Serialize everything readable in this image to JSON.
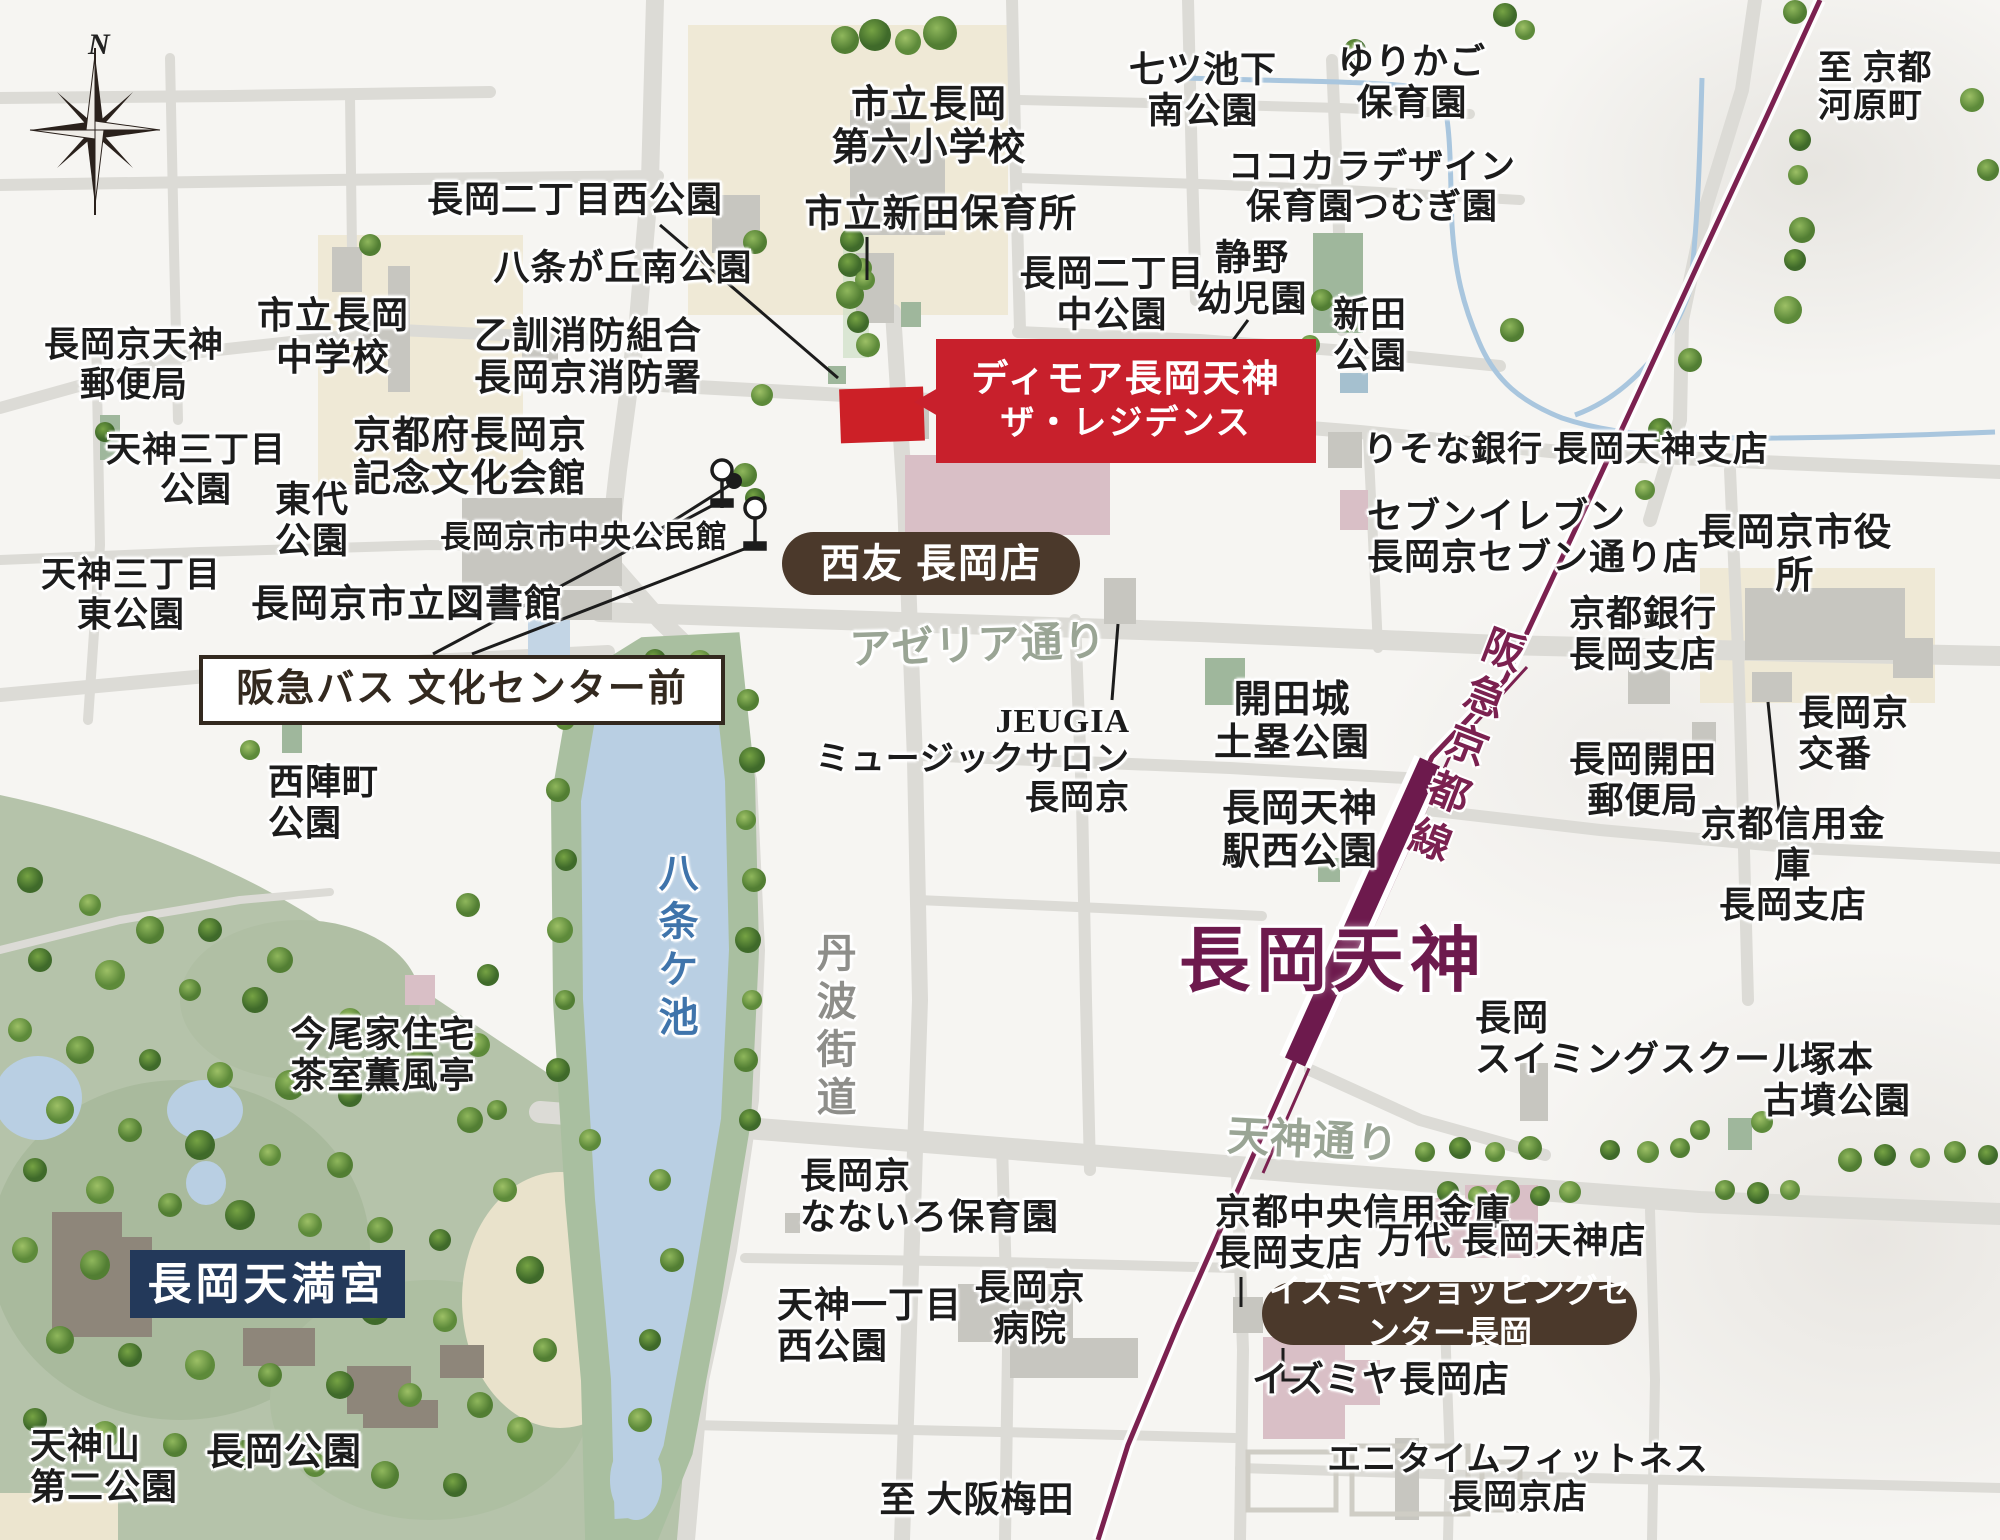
{
  "title": "長岡天神エリア 周辺案内図",
  "colors": {
    "railway_purple": "#7b2150",
    "station_text_purple": "#6d1a4d",
    "property_red": "#c8202c",
    "brand_brown": "#4b392b",
    "tenmangu_navy": "#23395a",
    "pond_blue": "#b9cfe3",
    "water_text_blue": "#3f74ab",
    "street_green": "#9aa595",
    "park_sage": "#b5c3aa"
  },
  "callouts": {
    "property": {
      "line1": "ディモア長岡天神",
      "line2": "ザ・レジデンス"
    },
    "seiyu": "西友 長岡店",
    "izumiya_sc": "イズミヤショッピングセンター長岡",
    "bus_stop": "阪急バス 文化センター前",
    "tenmangu": "長岡天満宮",
    "station": "長岡天神",
    "railway": "阪急京都線"
  },
  "compass": {
    "north": "N"
  },
  "map_labels": [
    {
      "name": "label-post-office-tenjin",
      "text": "長岡京天神\n郵便局",
      "x": 134,
      "y": 365,
      "fs": 35
    },
    {
      "name": "label-tenjin3-park",
      "text": "天神三丁目\n公園",
      "x": 196,
      "y": 470,
      "fs": 35
    },
    {
      "name": "label-tenjin3-east-park",
      "text": "天神三丁目\n東公園",
      "x": 131,
      "y": 595,
      "fs": 35
    },
    {
      "name": "label-municipal-jhs",
      "text": "市立長岡\n中学校",
      "x": 333,
      "y": 338,
      "fs": 37
    },
    {
      "name": "label-nagaoka2-west-park",
      "text": "長岡二丁目西公園",
      "x": 575,
      "y": 200,
      "fs": 36
    },
    {
      "name": "label-hachijo-south-park",
      "text": "八条が丘南公園",
      "x": 623,
      "y": 268,
      "fs": 36
    },
    {
      "name": "label-otokuni-fire-station",
      "text": "乙訓消防組合\n長岡京消防署",
      "x": 588,
      "y": 358,
      "fs": 37
    },
    {
      "name": "label-elementary-school",
      "text": "市立長岡\n第六小学校",
      "x": 929,
      "y": 127,
      "fs": 38
    },
    {
      "name": "label-shinden-nursery",
      "text": "市立新田保育所",
      "x": 941,
      "y": 215,
      "fs": 38
    },
    {
      "name": "label-nanatsuike-park",
      "text": "七ツ池下\n南公園",
      "x": 1203,
      "y": 90,
      "fs": 36
    },
    {
      "name": "label-yurikago-nursery",
      "text": "ゆりかご\n保育園",
      "x": 1412,
      "y": 82,
      "fs": 36
    },
    {
      "name": "label-kokokara-nursery",
      "text": "ココカラデザイン\n保育園つむぎ園",
      "x": 1372,
      "y": 187,
      "fs": 35
    },
    {
      "name": "label-to-kyoto-kawaramachi",
      "text": "至 京都\n河原町",
      "x": 1874,
      "y": 84,
      "fs": 34,
      "align": "left",
      "ax": 1818,
      "ay": 50
    },
    {
      "name": "label-nagaoka2-naka-park",
      "text": "長岡二丁目\n中公園",
      "x": 1112,
      "y": 294,
      "fs": 36
    },
    {
      "name": "label-shizuno-kindergarten",
      "text": "静野\n幼児園",
      "x": 1252,
      "y": 278,
      "fs": 36
    },
    {
      "name": "label-shinden-park",
      "text": "新田\n公園",
      "x": 1370,
      "y": 335,
      "fs": 36
    },
    {
      "name": "label-bunka-kaikan",
      "text": "京都府長岡京\n記念文化会館",
      "x": 470,
      "y": 458,
      "fs": 38
    },
    {
      "name": "label-todai-park",
      "text": "東代\n公園",
      "x": 312,
      "y": 520,
      "fs": 36
    },
    {
      "name": "label-chuo-kominkan",
      "text": "長岡京市中央公民館",
      "x": 584,
      "y": 537,
      "fs": 31
    },
    {
      "name": "label-city-library",
      "text": "長岡京市立図書館",
      "x": 407,
      "y": 605,
      "fs": 38
    },
    {
      "name": "label-risona-bank",
      "text": "りそな銀行 長岡天神支店",
      "x": 1566,
      "y": 450,
      "fs": 35
    },
    {
      "name": "label-seven-eleven",
      "text": "セブンイレブン\n長岡京セブン通り店",
      "x": 1530,
      "y": 538,
      "fs": 36,
      "align": "left",
      "ax": 1367,
      "ay": 496
    },
    {
      "name": "label-city-hall",
      "text": "長岡京市役所",
      "x": 1795,
      "y": 555,
      "fs": 38
    },
    {
      "name": "label-kyoto-bank",
      "text": "京都銀行\n長岡支店",
      "x": 1643,
      "y": 634,
      "fs": 36
    },
    {
      "name": "label-koban",
      "text": "長岡京\n交番",
      "x": 1845,
      "y": 733,
      "fs": 36,
      "align": "left",
      "ax": 1798,
      "ay": 693
    },
    {
      "name": "label-kaiden-post",
      "text": "長岡開田\n郵便局",
      "x": 1643,
      "y": 780,
      "fs": 36
    },
    {
      "name": "label-kyoto-shinyo",
      "text": "京都信用金庫\n長岡支店",
      "x": 1793,
      "y": 865,
      "fs": 36
    },
    {
      "name": "label-kaidenjo-park",
      "text": "開田城\n土塁公園",
      "x": 1292,
      "y": 722,
      "fs": 38
    },
    {
      "name": "label-jeugia",
      "text": "JEUGIA\nミュージックサロン\n長岡京",
      "x": 1014,
      "y": 760,
      "fs": 34,
      "align": "right",
      "ax": 1130,
      "ay": 703
    },
    {
      "name": "label-ekinishi-park",
      "text": "長岡天神\n駅西公園",
      "x": 1300,
      "y": 831,
      "fs": 38
    },
    {
      "name": "label-nishijin-park",
      "text": "西陣町\n公園",
      "x": 316,
      "y": 800,
      "fs": 36,
      "align": "left",
      "ax": 268,
      "ay": 762
    },
    {
      "name": "label-imao-house",
      "text": "今尾家住宅\n茶室薫風亭",
      "x": 383,
      "y": 1055,
      "fs": 36
    },
    {
      "name": "label-hachijogaike",
      "text": "八条ケ池",
      "x": 675,
      "y": 948,
      "fs": 40,
      "color": "#3f74ab",
      "vert": true
    },
    {
      "name": "label-tanba-kaido",
      "text": "丹波街道",
      "x": 833,
      "y": 1028,
      "fs": 40,
      "color": "#8e8e8a",
      "vert": true
    },
    {
      "name": "label-azeria-dori",
      "text": "アゼリア通り",
      "x": 978,
      "y": 647,
      "fs": 42,
      "color": "#9aa595",
      "rot": -2
    },
    {
      "name": "label-tenjin-dori",
      "text": "天神通り",
      "x": 1313,
      "y": 1142,
      "fs": 42,
      "color": "#9aa595",
      "rot": 3
    },
    {
      "name": "label-swimming-school",
      "text": "長岡\nスイミングスクール",
      "x": 1600,
      "y": 1036,
      "fs": 36,
      "align": "left",
      "ax": 1475,
      "ay": 998
    },
    {
      "name": "label-tsukamoto-kofun",
      "text": "塚本\n古墳公園",
      "x": 1837,
      "y": 1080,
      "fs": 36
    },
    {
      "name": "label-chuo-shinkin",
      "text": "京都中央信用金庫\n長岡支店",
      "x": 1306,
      "y": 1232,
      "fs": 36,
      "align": "left",
      "ax": 1215,
      "ay": 1192
    },
    {
      "name": "label-mandai",
      "text": "万代 長岡天神店",
      "x": 1512,
      "y": 1241,
      "fs": 36
    },
    {
      "name": "label-izumiya-store",
      "text": "イズミヤ長岡店",
      "x": 1381,
      "y": 1380,
      "fs": 36
    },
    {
      "name": "label-anytime-fitness",
      "text": "エニタイムフィットネス\n長岡京店",
      "x": 1518,
      "y": 1480,
      "fs": 34
    },
    {
      "name": "label-nanairo-nursery",
      "text": "長岡京\nなないろ保育園",
      "x": 918,
      "y": 1196,
      "fs": 36,
      "align": "left",
      "ax": 800,
      "ay": 1156
    },
    {
      "name": "label-tenjin1-west-park",
      "text": "天神一丁目\n西公園",
      "x": 866,
      "y": 1325,
      "fs": 36,
      "align": "left",
      "ax": 777,
      "ay": 1285
    },
    {
      "name": "label-hospital",
      "text": "長岡京\n病院",
      "x": 1030,
      "y": 1308,
      "fs": 36
    },
    {
      "name": "label-to-osaka-umeda",
      "text": "至 大阪梅田",
      "x": 977,
      "y": 1500,
      "fs": 36
    },
    {
      "name": "label-nagaoka-park",
      "text": "長岡公園",
      "x": 284,
      "y": 1453,
      "fs": 38
    },
    {
      "name": "label-tenjinyama-park",
      "text": "天神山\n第二公園",
      "x": 110,
      "y": 1466,
      "fs": 36,
      "align": "left",
      "ax": 30,
      "ay": 1426
    }
  ]
}
